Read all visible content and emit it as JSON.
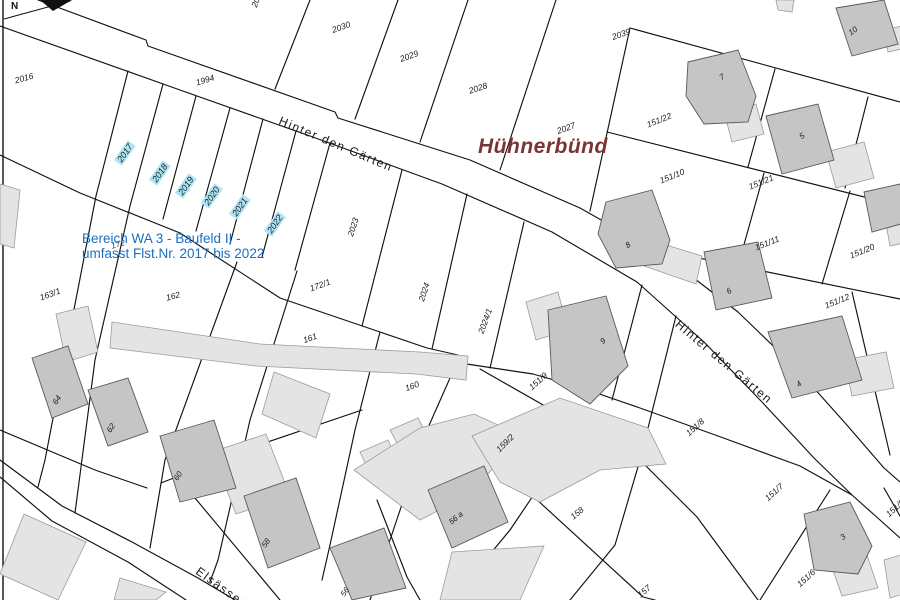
{
  "map": {
    "type": "cadastral-plan",
    "place_name": "Hühnerbünd",
    "north_label": "N",
    "annotation": {
      "line1": "Bereich WA 3 - Baufeld II -",
      "line2": "umfasst Flst.Nr. 2017 bis 2022"
    },
    "highlighted_parcel_numbers": [
      "2017",
      "2018",
      "2019",
      "2020",
      "2021",
      "2022"
    ],
    "street_names": [
      "Hinter den Gärten",
      "Elsässer"
    ],
    "labels": [
      {
        "t": "2016",
        "x": 24,
        "y": 78,
        "r": -15,
        "k": "parcel"
      },
      {
        "t": "1994",
        "x": 205,
        "y": 80,
        "r": -17,
        "k": "parcel"
      },
      {
        "t": "2031",
        "x": 257,
        "y": -2,
        "r": -70,
        "k": "parcel"
      },
      {
        "t": "2030",
        "x": 341,
        "y": 27,
        "r": -20,
        "k": "parcel"
      },
      {
        "t": "2029",
        "x": 409,
        "y": 56,
        "r": -20,
        "k": "parcel"
      },
      {
        "t": "2028",
        "x": 478,
        "y": 88,
        "r": -18,
        "k": "parcel"
      },
      {
        "t": "2027",
        "x": 566,
        "y": 128,
        "r": -20,
        "k": "parcel"
      },
      {
        "t": "2039",
        "x": 621,
        "y": 34,
        "r": -20,
        "k": "parcel"
      },
      {
        "t": "151/22",
        "x": 659,
        "y": 120,
        "r": -22,
        "k": "parcel"
      },
      {
        "t": "151/10",
        "x": 672,
        "y": 176,
        "r": -22,
        "k": "parcel"
      },
      {
        "t": "151/21",
        "x": 761,
        "y": 182,
        "r": -22,
        "k": "parcel"
      },
      {
        "t": "151/11",
        "x": 767,
        "y": 243,
        "r": -22,
        "k": "parcel"
      },
      {
        "t": "151/20",
        "x": 862,
        "y": 251,
        "r": -22,
        "k": "parcel"
      },
      {
        "t": "151/12",
        "x": 837,
        "y": 301,
        "r": -22,
        "k": "parcel"
      },
      {
        "t": "2023",
        "x": 353,
        "y": 227,
        "r": -72,
        "k": "parcel"
      },
      {
        "t": "2024",
        "x": 424,
        "y": 292,
        "r": -72,
        "k": "parcel"
      },
      {
        "t": "2024/1",
        "x": 485,
        "y": 321,
        "r": -70,
        "k": "parcel"
      },
      {
        "t": "172/1",
        "x": 320,
        "y": 285,
        "r": -20,
        "k": "parcel"
      },
      {
        "t": "161",
        "x": 310,
        "y": 338,
        "r": -20,
        "k": "parcel"
      },
      {
        "t": "160",
        "x": 412,
        "y": 386,
        "r": -20,
        "k": "parcel"
      },
      {
        "t": "163/1",
        "x": 50,
        "y": 294,
        "r": -20,
        "k": "parcel"
      },
      {
        "t": "172",
        "x": 118,
        "y": 244,
        "r": -15,
        "k": "parcel-dim"
      },
      {
        "t": "162",
        "x": 173,
        "y": 296,
        "r": -15,
        "k": "parcel"
      },
      {
        "t": "151/9",
        "x": 538,
        "y": 381,
        "r": -42,
        "k": "parcel"
      },
      {
        "t": "151/8",
        "x": 695,
        "y": 427,
        "r": -42,
        "k": "parcel"
      },
      {
        "t": "159/2",
        "x": 505,
        "y": 443,
        "r": -45,
        "k": "parcel"
      },
      {
        "t": "158",
        "x": 577,
        "y": 513,
        "r": -40,
        "k": "parcel"
      },
      {
        "t": "157",
        "x": 644,
        "y": 591,
        "r": -40,
        "k": "parcel"
      },
      {
        "t": "151/7",
        "x": 774,
        "y": 492,
        "r": -42,
        "k": "parcel"
      },
      {
        "t": "151/6",
        "x": 806,
        "y": 578,
        "r": -42,
        "k": "parcel"
      },
      {
        "t": "151/5",
        "x": 895,
        "y": 508,
        "r": -42,
        "k": "parcel"
      },
      {
        "t": "10",
        "x": 853,
        "y": 31,
        "r": -35,
        "k": "building"
      },
      {
        "t": "7",
        "x": 722,
        "y": 77,
        "r": -35,
        "k": "building"
      },
      {
        "t": "5",
        "x": 802,
        "y": 136,
        "r": -35,
        "k": "building"
      },
      {
        "t": "8",
        "x": 628,
        "y": 245,
        "r": -35,
        "k": "building"
      },
      {
        "t": "6",
        "x": 729,
        "y": 291,
        "r": -35,
        "k": "building"
      },
      {
        "t": "9",
        "x": 603,
        "y": 341,
        "r": -40,
        "k": "building"
      },
      {
        "t": "4",
        "x": 799,
        "y": 384,
        "r": -40,
        "k": "building"
      },
      {
        "t": "3",
        "x": 843,
        "y": 537,
        "r": -40,
        "k": "building"
      },
      {
        "t": "64",
        "x": 57,
        "y": 400,
        "r": -55,
        "k": "building"
      },
      {
        "t": "62",
        "x": 111,
        "y": 428,
        "r": -55,
        "k": "building"
      },
      {
        "t": "60",
        "x": 178,
        "y": 476,
        "r": -55,
        "k": "building"
      },
      {
        "t": "58",
        "x": 266,
        "y": 543,
        "r": -55,
        "k": "building"
      },
      {
        "t": "56",
        "x": 345,
        "y": 592,
        "r": -55,
        "k": "building"
      },
      {
        "t": "56 a",
        "x": 456,
        "y": 518,
        "r": -40,
        "k": "building"
      },
      {
        "t": "2017",
        "x": 125,
        "y": 153,
        "r": -55,
        "k": "highlight"
      },
      {
        "t": "2018",
        "x": 160,
        "y": 173,
        "r": -55,
        "k": "highlight"
      },
      {
        "t": "2019",
        "x": 186,
        "y": 186,
        "r": -55,
        "k": "highlight"
      },
      {
        "t": "2020",
        "x": 212,
        "y": 196,
        "r": -55,
        "k": "highlight"
      },
      {
        "t": "2021",
        "x": 240,
        "y": 207,
        "r": -55,
        "k": "highlight"
      },
      {
        "t": "2022",
        "x": 275,
        "y": 224,
        "r": -55,
        "k": "highlight"
      },
      {
        "t": "Hinter den Gärten",
        "x": 336,
        "y": 144,
        "r": 23,
        "k": "street"
      },
      {
        "t": "Hinter den Gärten",
        "x": 724,
        "y": 362,
        "r": 40,
        "k": "street"
      },
      {
        "t": "Elsässer",
        "x": 221,
        "y": 587,
        "r": 36,
        "k": "street"
      }
    ]
  },
  "colors": {
    "background": "#ffffff",
    "boundary_line": "#111111",
    "building_fill": "#c5c5c5",
    "building_outline": "#595959",
    "garage_fill": "#e4e4e4",
    "garage_outline": "#9b9b9b",
    "highlight_cyan": "#ade4f4",
    "annotation_blue": "#1a6fbe",
    "place_name_maroon": "#7b3434",
    "label_color": "#1a1a1a"
  }
}
